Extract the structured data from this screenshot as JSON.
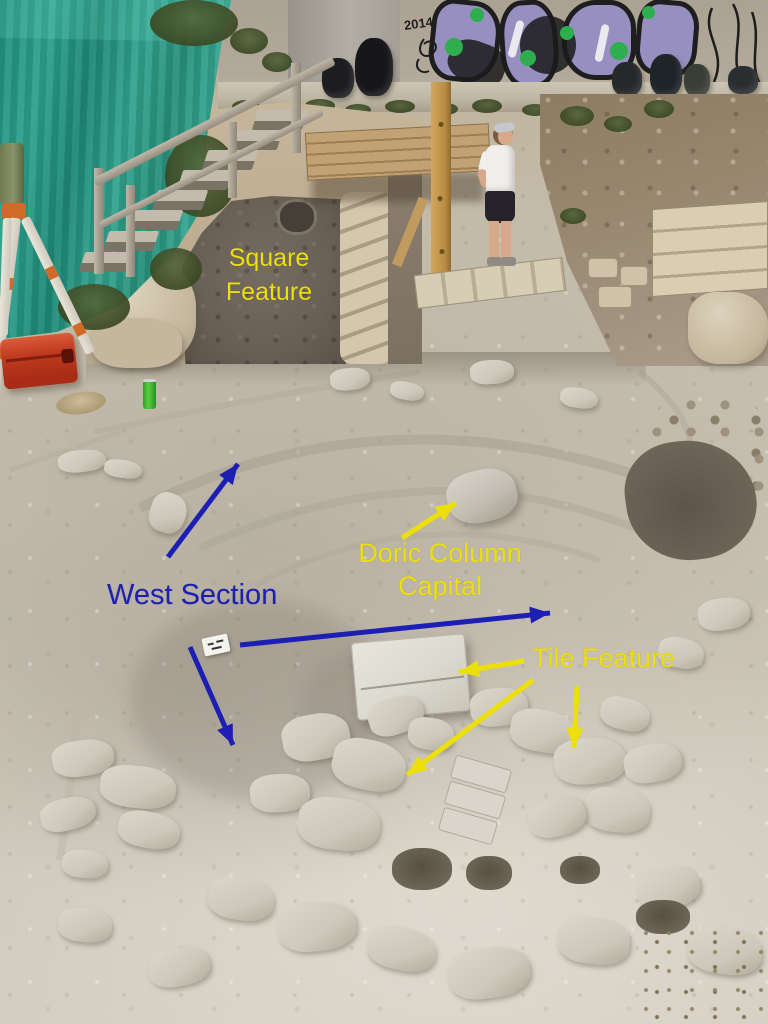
{
  "scene": {
    "graffiti_year": "2014"
  },
  "annotations": {
    "colors": {
      "yellow": "#ecdf0a",
      "blue": "#1d1fb4"
    },
    "labels": [
      {
        "id": "square-feature",
        "text": "Square\nFeature",
        "color": "yellow"
      },
      {
        "id": "west-section",
        "text": "West Section",
        "color": "blue"
      },
      {
        "id": "doric-column-capital",
        "text": "Doric Column\nCapital",
        "color": "yellow"
      },
      {
        "id": "tile-feature",
        "text": "Tile Feature",
        "color": "yellow"
      }
    ],
    "arrows": [
      {
        "label": "west-section",
        "color": "blue",
        "x1": 168,
        "y1": 557,
        "x2": 238,
        "y2": 464
      },
      {
        "label": "west-section",
        "color": "blue",
        "x1": 190,
        "y1": 647,
        "x2": 233,
        "y2": 745
      },
      {
        "label": "west-section",
        "color": "blue",
        "x1": 240,
        "y1": 645,
        "x2": 550,
        "y2": 613
      },
      {
        "label": "doric-column-capital",
        "color": "yellow",
        "x1": 402,
        "y1": 538,
        "x2": 456,
        "y2": 503
      },
      {
        "label": "tile-feature",
        "color": "yellow",
        "x1": 524,
        "y1": 661,
        "x2": 459,
        "y2": 672
      },
      {
        "label": "tile-feature",
        "color": "yellow",
        "x1": 533,
        "y1": 680,
        "x2": 407,
        "y2": 775
      },
      {
        "label": "tile-feature",
        "color": "yellow",
        "x1": 577,
        "y1": 686,
        "x2": 574,
        "y2": 748
      }
    ]
  }
}
